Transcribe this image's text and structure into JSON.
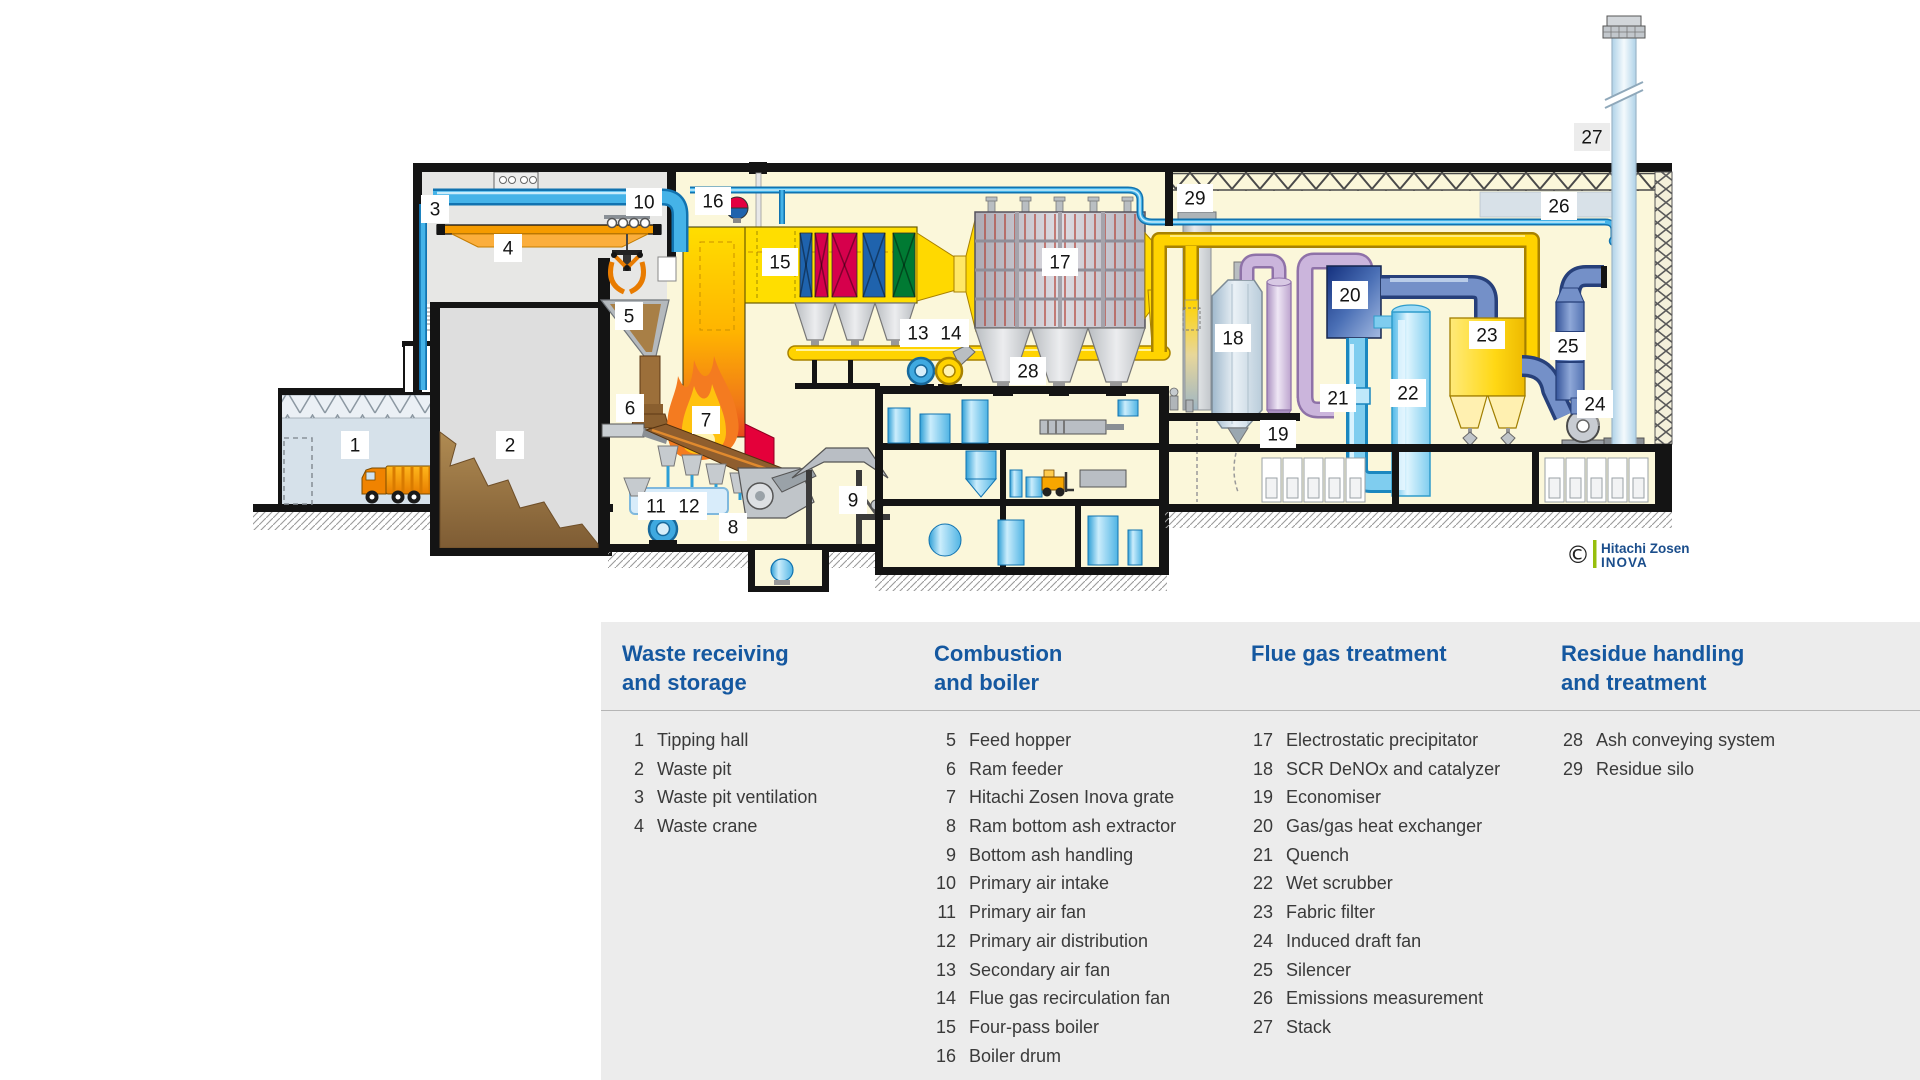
{
  "diagram": {
    "title": "waste-to-energy-plant-cross-section",
    "copyright": {
      "symbol": "©",
      "line1": "Hitachi Zosen",
      "line2": "INOVA"
    },
    "labels": [
      {
        "num": "1",
        "x": 355,
        "y": 445
      },
      {
        "num": "2",
        "x": 510,
        "y": 445
      },
      {
        "num": "3",
        "x": 435,
        "y": 209
      },
      {
        "num": "4",
        "x": 508,
        "y": 248
      },
      {
        "num": "5",
        "x": 629,
        "y": 316
      },
      {
        "num": "6",
        "x": 630,
        "y": 408
      },
      {
        "num": "7",
        "x": 706,
        "y": 420
      },
      {
        "num": "8",
        "x": 733,
        "y": 527
      },
      {
        "num": "9",
        "x": 853,
        "y": 500
      },
      {
        "num": "10",
        "x": 644,
        "y": 202
      },
      {
        "num": "11",
        "x": 656,
        "y": 506
      },
      {
        "num": "12",
        "x": 689,
        "y": 506
      },
      {
        "num": "13",
        "x": 918,
        "y": 333
      },
      {
        "num": "14",
        "x": 951,
        "y": 333
      },
      {
        "num": "15",
        "x": 780,
        "y": 262
      },
      {
        "num": "16",
        "x": 713,
        "y": 201
      },
      {
        "num": "17",
        "x": 1060,
        "y": 262
      },
      {
        "num": "18",
        "x": 1233,
        "y": 338
      },
      {
        "num": "19",
        "x": 1278,
        "y": 434
      },
      {
        "num": "20",
        "x": 1350,
        "y": 295
      },
      {
        "num": "21",
        "x": 1338,
        "y": 398
      },
      {
        "num": "22",
        "x": 1408,
        "y": 393
      },
      {
        "num": "23",
        "x": 1487,
        "y": 335
      },
      {
        "num": "24",
        "x": 1595,
        "y": 404
      },
      {
        "num": "25",
        "x": 1568,
        "y": 346
      },
      {
        "num": "26",
        "x": 1559,
        "y": 206
      },
      {
        "num": "27",
        "x": 1592,
        "y": 137,
        "bg": "#ECECEC"
      },
      {
        "num": "28",
        "x": 1028,
        "y": 371
      },
      {
        "num": "29",
        "x": 1195,
        "y": 198
      }
    ]
  },
  "legend": {
    "background": "#ECECEC",
    "heading_color": "#1558A0",
    "columns": [
      {
        "id": "waste-receiving-and-storage",
        "title_lines": [
          "Waste receiving",
          "and storage"
        ],
        "items": [
          {
            "num": "1",
            "label": "Tipping hall"
          },
          {
            "num": "2",
            "label": "Waste pit"
          },
          {
            "num": "3",
            "label": "Waste pit ventilation"
          },
          {
            "num": "4",
            "label": "Waste crane"
          }
        ]
      },
      {
        "id": "combustion-and-boiler",
        "title_lines": [
          "Combustion",
          "and boiler"
        ],
        "items": [
          {
            "num": "5",
            "label": "Feed hopper"
          },
          {
            "num": "6",
            "label": "Ram feeder"
          },
          {
            "num": "7",
            "label": "Hitachi Zosen Inova grate"
          },
          {
            "num": "8",
            "label": "Ram bottom ash extractor"
          },
          {
            "num": "9",
            "label": "Bottom ash handling"
          },
          {
            "num": "10",
            "label": "Primary air intake"
          },
          {
            "num": "11",
            "label": "Primary air fan"
          },
          {
            "num": "12",
            "label": "Primary air distribution"
          },
          {
            "num": "13",
            "label": "Secondary air fan"
          },
          {
            "num": "14",
            "label": "Flue gas recirculation fan"
          },
          {
            "num": "15",
            "label": "Four-pass boiler"
          },
          {
            "num": "16",
            "label": "Boiler drum"
          }
        ]
      },
      {
        "id": "flue-gas-treatment",
        "title_lines": [
          "Flue gas treatment"
        ],
        "items": [
          {
            "num": "17",
            "label": "Electrostatic precipitator"
          },
          {
            "num": "18",
            "label": "SCR DeNOx and catalyzer"
          },
          {
            "num": "19",
            "label": "Economiser"
          },
          {
            "num": "20",
            "label": "Gas/gas heat exchanger"
          },
          {
            "num": "21",
            "label": "Quench"
          },
          {
            "num": "22",
            "label": "Wet scrubber"
          },
          {
            "num": "23",
            "label": "Fabric filter"
          },
          {
            "num": "24",
            "label": "Induced draft fan"
          },
          {
            "num": "25",
            "label": "Silencer"
          },
          {
            "num": "26",
            "label": "Emissions measurement"
          },
          {
            "num": "27",
            "label": "Stack"
          }
        ]
      },
      {
        "id": "residue-handling-and-treatment",
        "title_lines": [
          "Residue handling",
          "and treatment"
        ],
        "items": [
          {
            "num": "28",
            "label": "Ash conveying system"
          },
          {
            "num": "29",
            "label": "Residue silo"
          }
        ]
      }
    ]
  },
  "colors": {
    "legend_bg": "#ECECEC",
    "heading_blue": "#1558A0",
    "item_text": "#3A3A3A",
    "cream_interior": "#FBF7DA",
    "boiler_yellow": "#FFDE00",
    "duct_yellow": "#FFD300",
    "crane_orange": "#F59B00",
    "flame_orange": "#F47B20",
    "crimson_bundle": "#D6004C",
    "blue_bundle": "#1F63AD",
    "green_bundle": "#007A33",
    "pipe_blue": "#45B3E8",
    "steel_blue": "#7490C8",
    "lavender": "#CBB5DC",
    "logo_green": "#97BF0D",
    "logo_blue": "#1B4E8C"
  }
}
